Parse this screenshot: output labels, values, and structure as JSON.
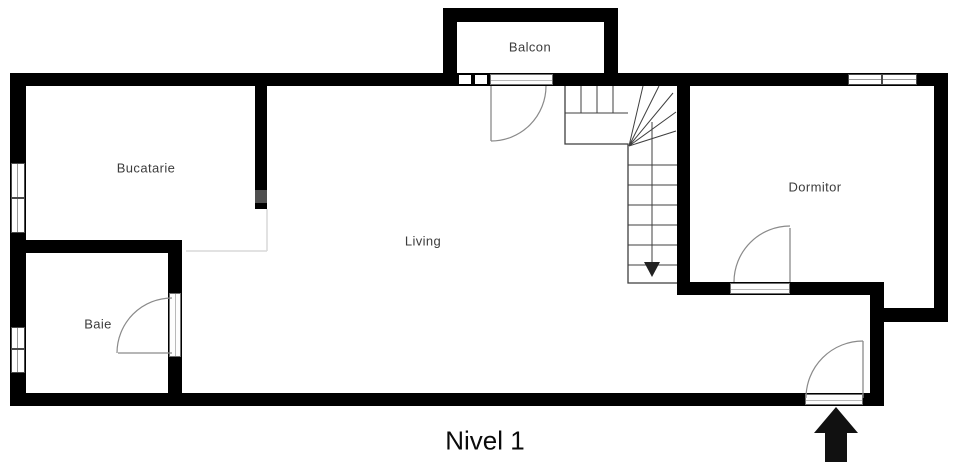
{
  "rooms": {
    "balcon": {
      "label": "Balcon"
    },
    "bucatarie": {
      "label": "Bucatarie"
    },
    "living": {
      "label": "Living"
    },
    "dormitor": {
      "label": "Dormitor"
    },
    "baie": {
      "label": "Baie"
    }
  },
  "level": {
    "label": "Nivel 1"
  },
  "icons": {
    "entrance_arrow": "up-arrow",
    "stairs_direction_arrow": "down-arrow"
  },
  "colors": {
    "wall": "#000000",
    "wall_accent_gray": "#4f4f4f",
    "thin_line": "#444444",
    "door_arc": "#888888",
    "background": "#ffffff",
    "label_text": "#3c3c3c"
  }
}
